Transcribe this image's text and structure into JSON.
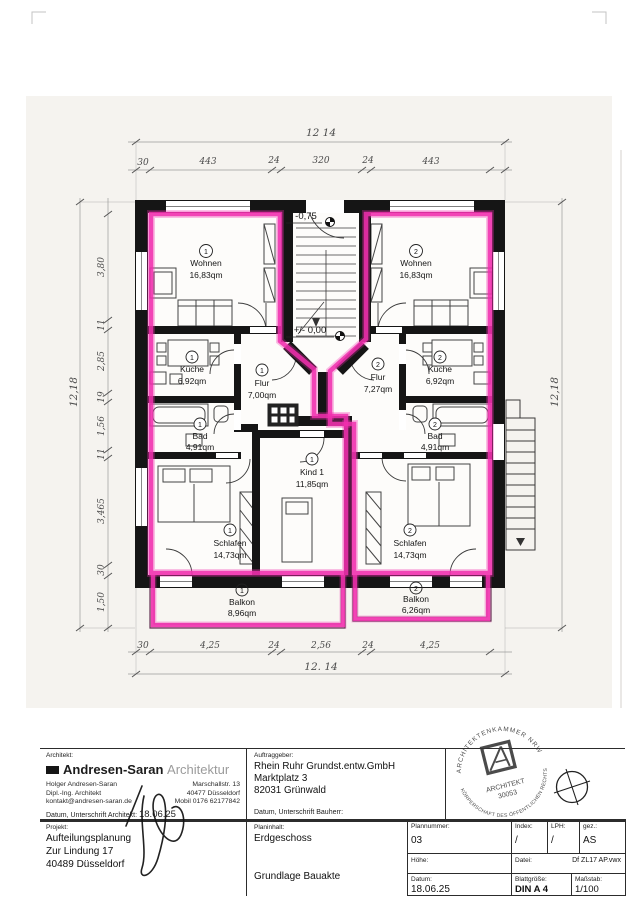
{
  "colors": {
    "highlight": "#f12fae",
    "wall": "#151515"
  },
  "plan": {
    "levels": {
      "upper_label": "-0,75",
      "ground_label": "+/- 0,00"
    },
    "rooms": [
      {
        "unit": "1",
        "name": "Wohnen",
        "area": "16,83qm"
      },
      {
        "unit": "2",
        "name": "Wohnen",
        "area": "16,83qm"
      },
      {
        "unit": "1",
        "name": "Küche",
        "area": "6,92qm"
      },
      {
        "unit": "1",
        "name": "Flur",
        "area": "7,00qm"
      },
      {
        "unit": "2",
        "name": "Flur",
        "area": "7,27qm"
      },
      {
        "unit": "2",
        "name": "Küche",
        "area": "6,92qm"
      },
      {
        "unit": "1",
        "name": "Bad",
        "area": "4,91qm"
      },
      {
        "unit": "2",
        "name": "Bad",
        "area": "4,91qm"
      },
      {
        "unit": "1",
        "name": "Kind 1",
        "area": "11,85qm"
      },
      {
        "unit": "1",
        "name": "Schlafen",
        "area": "14,73qm"
      },
      {
        "unit": "2",
        "name": "Schlafen",
        "area": "14,73qm"
      },
      {
        "unit": "1",
        "name": "Balkon",
        "area": "8,96qm"
      },
      {
        "unit": "2",
        "name": "Balkon",
        "area": "6,26qm"
      }
    ],
    "dims": {
      "top_total": "12 14",
      "top_segs": [
        "30",
        "443",
        "24",
        "320",
        "24",
        "443"
      ],
      "bottom_segs": [
        "30",
        "4,25",
        "24",
        "2,56",
        "24",
        "4,25"
      ],
      "bottom_total": "12. 14",
      "left_total": "12,18",
      "left_segs": [
        "3,80",
        "11",
        "2,85",
        "19",
        "1,56",
        "11",
        "3,465",
        "30",
        "1,50"
      ],
      "right_total": "12,18"
    }
  },
  "titleblock": {
    "architect": {
      "label": "Architekt:",
      "firm_bold": "Andresen-Saran",
      "firm_light": "Architektur",
      "line_l0": "Holger Andresen-Saran",
      "line_l1": "Dipl.-Ing. Architekt",
      "line_l2": "kontakt@andresen-saran.de",
      "line_r0": "Marschallstr. 13",
      "line_r1": "40477 Düsseldorf",
      "line_r2": "Mobil 0176 62177842",
      "signature_label": "Datum, Unterschrift Architekt:",
      "signature_date": "18.06.25"
    },
    "client": {
      "label": "Auftraggeber:",
      "line0": "Rhein Ruhr Grundst.entw.GmbH",
      "line1": "Marktplatz 3",
      "line2": "82031 Grünwald",
      "signature_label": "Datum, Unterschrift Bauherr:"
    },
    "project": {
      "label": "Projekt:",
      "line0": "Aufteilungsplanung",
      "line1": "Zur Lindung 17",
      "line2": "40489 Düsseldorf"
    },
    "content": {
      "label": "Planinhalt:",
      "title": "Erdgeschoss",
      "subtitle": "Grundlage Bauakte"
    },
    "stamp": {
      "arc_top": "ARCHITEKTENKAMMER NRW",
      "arc_bottom": "KÖRPERSCHAFT DES ÖFFENTLICHEN RECHTS",
      "line1": "ARCHITEKT",
      "line2": "30053"
    },
    "fields": {
      "plannummer_label": "Plannummer:",
      "plannummer": "03",
      "index_label": "Index:",
      "index": "/",
      "lph_label": "LPH:",
      "lph": "/",
      "gez_label": "gez.:",
      "gez": "AS",
      "hoehe_label": "Höhe:",
      "hoehe": "",
      "datei_label": "Datei:",
      "datei": "Df ZL17 AP.vwx",
      "datum_label": "Datum:",
      "datum": "18.06.25",
      "blatt_label": "Blattgröße:",
      "blatt": "DIN A 4",
      "massstab_label": "Maßstab:",
      "massstab": "1/100"
    }
  }
}
